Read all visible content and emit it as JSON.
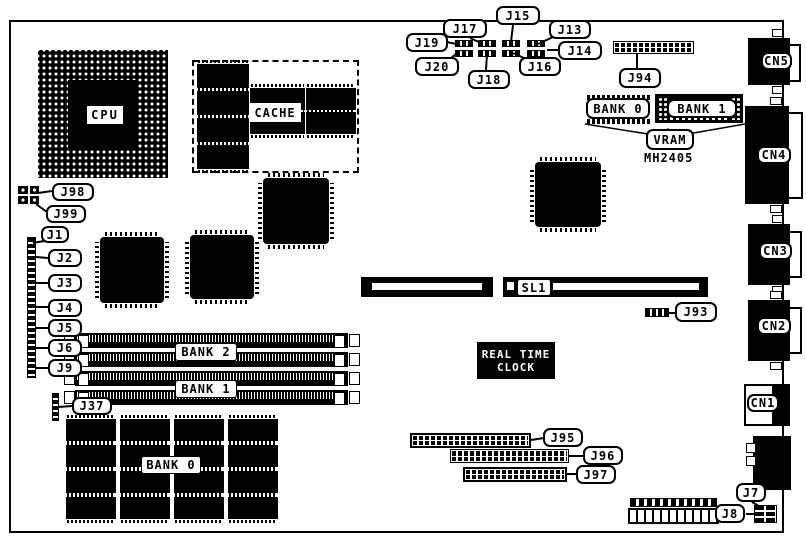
{
  "diagram_title": "Motherboard component location diagram",
  "callouts": {
    "j1": "J1",
    "j2": "J2",
    "j3": "J3",
    "j4": "J4",
    "j5": "J5",
    "j6": "J6",
    "j7": "J7",
    "j8": "J8",
    "j9": "J9",
    "j13": "J13",
    "j14": "J14",
    "j15": "J15",
    "j16": "J16",
    "j17": "J17",
    "j18": "J18",
    "j19": "J19",
    "j20": "J20",
    "j37": "J37",
    "j93": "J93",
    "j94": "J94",
    "j95": "J95",
    "j96": "J96",
    "j97": "J97",
    "j98": "J98",
    "j99": "J99"
  },
  "chips": {
    "cpu": "CPU",
    "cache": "CACHE",
    "mh2405": "MH2405",
    "rtc_line1": "REAL TIME",
    "rtc_line2": "CLOCK"
  },
  "slots": {
    "sl1": "SL1"
  },
  "banks": {
    "vram_bank0": "BANK 0",
    "vram_bank1": "BANK 1",
    "vram": "VRAM",
    "simm_bank2": "BANK 2",
    "simm_bank1": "BANK 1",
    "dram_bank0": "BANK 0"
  },
  "connectors": {
    "cn1": "CN1",
    "cn2": "CN2",
    "cn3": "CN3",
    "cn4": "CN4",
    "cn5": "CN5"
  },
  "colors": {
    "ink": "#000000",
    "paper": "#ffffff"
  }
}
